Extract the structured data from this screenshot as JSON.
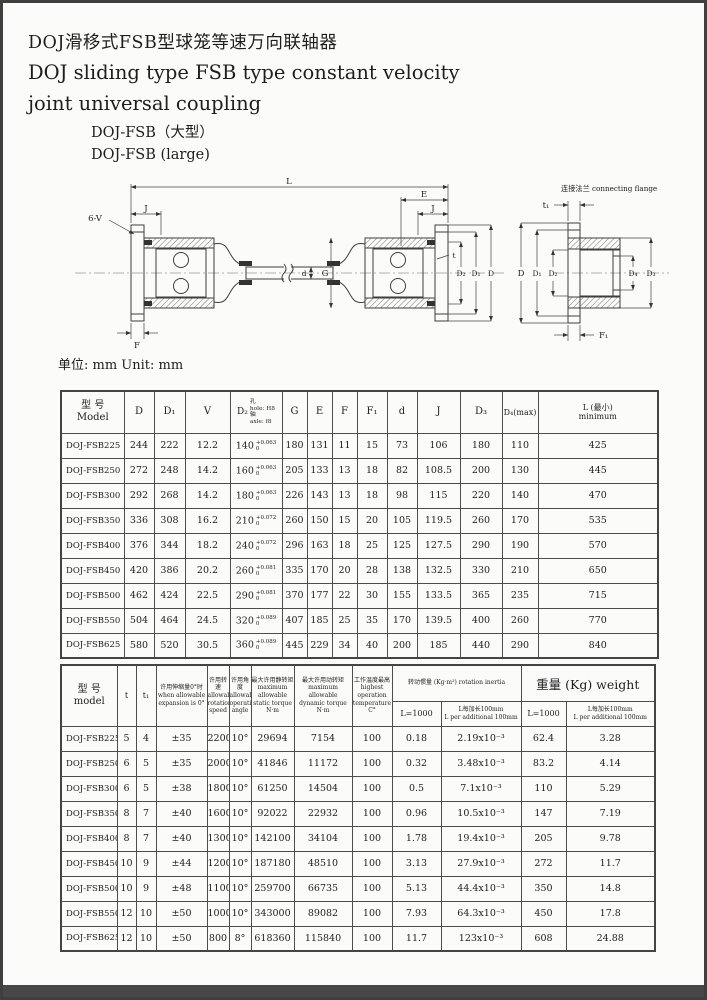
{
  "page": {
    "title_zh": "DOJ滑移式FSB型球笼等速万向联轴器",
    "title_en": "DOJ sliding type FSB type constant velocity\njoint universal coupling",
    "subtitle": "DOJ-FSB（大型）\nDOJ-FSB (large)",
    "unit_note": "单位: mm Unit: mm"
  },
  "drawing": {
    "caption": "连接法兰 connecting flange",
    "labels": {
      "L": "L",
      "E": "E",
      "J": "J",
      "sixV": "6-V",
      "t": "t",
      "d": "d",
      "G": "G",
      "D": "D",
      "D1": "D₁",
      "D2": "D₂",
      "D3": "D₃",
      "D4": "D₄",
      "F": "F",
      "F1": "F₁",
      "t1": "t₁"
    }
  },
  "table1": {
    "headers": {
      "model": "型 号\nModel",
      "d": "D",
      "d1": "D₁",
      "v": "V",
      "d2_sym": "D₂",
      "d2_lines": "孔\nhole: H8\n轴\naxle: f8",
      "g": "G",
      "e": "E",
      "f": "F",
      "f1": "F₁",
      "dd": "d",
      "j": "J",
      "d3": "D₃",
      "d4": "D₄(max)",
      "l": "L (最小)\nminimum"
    },
    "rows": [
      [
        "DOJ-FSB225",
        "244",
        "222",
        "12.2",
        {
          "size": "140",
          "up": "+0.063",
          "dn": "0"
        },
        "180",
        "131",
        "11",
        "15",
        "73",
        "106",
        "180",
        "110",
        "425"
      ],
      [
        "DOJ-FSB250",
        "272",
        "248",
        "14.2",
        {
          "size": "160",
          "up": "+0.063",
          "dn": "0"
        },
        "205",
        "133",
        "13",
        "18",
        "82",
        "108.5",
        "200",
        "130",
        "445"
      ],
      [
        "DOJ-FSB300",
        "292",
        "268",
        "14.2",
        {
          "size": "180",
          "up": "+0.063",
          "dn": "0"
        },
        "226",
        "143",
        "13",
        "18",
        "98",
        "115",
        "220",
        "140",
        "470"
      ],
      [
        "DOJ-FSB350",
        "336",
        "308",
        "16.2",
        {
          "size": "210",
          "up": "+0.072",
          "dn": "0"
        },
        "260",
        "150",
        "15",
        "20",
        "105",
        "119.5",
        "260",
        "170",
        "535"
      ],
      [
        "DOJ-FSB400",
        "376",
        "344",
        "18.2",
        {
          "size": "240",
          "up": "+0.072",
          "dn": "0"
        },
        "296",
        "163",
        "18",
        "25",
        "125",
        "127.5",
        "290",
        "190",
        "570"
      ],
      [
        "DOJ-FSB450",
        "420",
        "386",
        "20.2",
        {
          "size": "260",
          "up": "+0.081",
          "dn": "0"
        },
        "335",
        "170",
        "20",
        "28",
        "138",
        "132.5",
        "330",
        "210",
        "650"
      ],
      [
        "DOJ-FSB500",
        "462",
        "424",
        "22.5",
        {
          "size": "290",
          "up": "+0.081",
          "dn": "0"
        },
        "370",
        "177",
        "22",
        "30",
        "155",
        "133.5",
        "365",
        "235",
        "715"
      ],
      [
        "DOJ-FSB550",
        "504",
        "464",
        "24.5",
        {
          "size": "320",
          "up": "+0.089",
          "dn": "0"
        },
        "407",
        "185",
        "25",
        "35",
        "170",
        "139.5",
        "400",
        "260",
        "770"
      ],
      [
        "DOJ-FSB625",
        "580",
        "520",
        "30.5",
        {
          "size": "360",
          "up": "+0.089",
          "dn": "0"
        },
        "445",
        "229",
        "34",
        "40",
        "200",
        "185",
        "440",
        "290",
        "840"
      ]
    ]
  },
  "table2": {
    "headers": {
      "model": "型 号\nmodel",
      "t": "t",
      "t1": "t₁",
      "exp": "许用伸缩量0°时\nwhen allowable\nexpansion is 0°",
      "speed": "许用转速\nallowable\nrotation\nspeed",
      "angle": "许用角度\nallowable\noperation\nangle",
      "statict": "最大许用静转矩\nmaximum allowable\nstatic torque\nN·m",
      "dynamict": "最大许用动转矩\nmaximum allowable\ndynamic torque\nN·m",
      "temp": "工作温度最高\nhighest operation\ntemperature\nC°",
      "inertia_group": "转动惯量 (Kg·m²) rotation inertia",
      "weight_group": "重量 (Kg) weight",
      "l1000": "L=1000",
      "per100": "L每加长100mm\nL per additional 100mm"
    },
    "rows": [
      [
        "DOJ-FSB225",
        "5",
        "4",
        "±35",
        "2200",
        "10°",
        "29694",
        "7154",
        "100",
        "0.18",
        "2.19x10⁻³",
        "62.4",
        "3.28"
      ],
      [
        "DOJ-FSB250",
        "6",
        "5",
        "±35",
        "2000",
        "10°",
        "41846",
        "11172",
        "100",
        "0.32",
        "3.48x10⁻³",
        "83.2",
        "4.14"
      ],
      [
        "DOJ-FSB300",
        "6",
        "5",
        "±38",
        "1800",
        "10°",
        "61250",
        "14504",
        "100",
        "0.5",
        "7.1x10⁻³",
        "110",
        "5.29"
      ],
      [
        "DOJ-FSB350",
        "8",
        "7",
        "±40",
        "1600",
        "10°",
        "92022",
        "22932",
        "100",
        "0.96",
        "10.5x10⁻³",
        "147",
        "7.19"
      ],
      [
        "DOJ-FSB400",
        "8",
        "7",
        "±40",
        "1300",
        "10°",
        "142100",
        "34104",
        "100",
        "1.78",
        "19.4x10⁻³",
        "205",
        "9.78"
      ],
      [
        "DOJ-FSB450",
        "10",
        "9",
        "±44",
        "1200",
        "10°",
        "187180",
        "48510",
        "100",
        "3.13",
        "27.9x10⁻³",
        "272",
        "11.7"
      ],
      [
        "DOJ-FSB500",
        "10",
        "9",
        "±48",
        "1100",
        "10°",
        "259700",
        "66735",
        "100",
        "5.13",
        "44.4x10⁻³",
        "350",
        "14.8"
      ],
      [
        "DOJ-FSB550",
        "12",
        "10",
        "±50",
        "1000",
        "10°",
        "343000",
        "89082",
        "100",
        "7.93",
        "64.3x10⁻³",
        "450",
        "17.8"
      ],
      [
        "DOJ-FSB625",
        "12",
        "10",
        "±50",
        "800",
        "8°",
        "618360",
        "115840",
        "100",
        "11.7",
        "123x10⁻³",
        "608",
        "24.88"
      ]
    ]
  }
}
